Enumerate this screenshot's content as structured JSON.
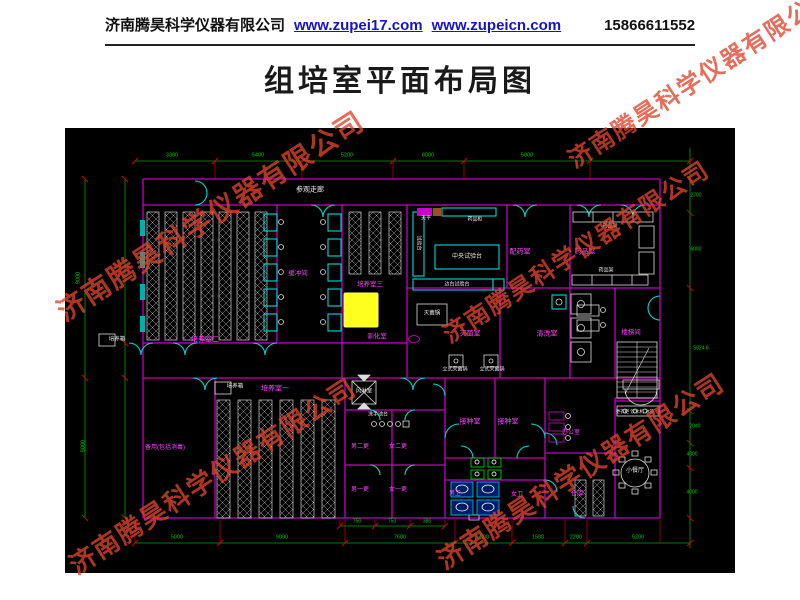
{
  "header": {
    "company": "济南腾昊科学仪器有限公司",
    "url1": "www.zupei17.com",
    "url2": "www.zupeicn.com",
    "phone": "15866611552"
  },
  "title": "组培室平面布局图",
  "watermark": {
    "text": "济南腾昊科学仪器有限公司",
    "color": "#e0452e",
    "positions": [
      {
        "x": 210,
        "y": 215,
        "s": 28
      },
      {
        "x": 700,
        "y": 75,
        "s": 24
      },
      {
        "x": 575,
        "y": 250,
        "s": 24
      },
      {
        "x": 212,
        "y": 475,
        "s": 26
      },
      {
        "x": 580,
        "y": 470,
        "s": 26
      }
    ]
  },
  "plan": {
    "colors": {
      "wall": "#c400c4",
      "door": "#00d8d8",
      "dimension": "#00a000",
      "tick": "#d40000",
      "rack": "#cfcfcf",
      "highlight": "#ffff1e",
      "room_label": "#ff45ff",
      "text": "#e8e8e8"
    },
    "labels": [
      {
        "t": "参观走廊",
        "x": 245,
        "y": 62,
        "cls": "w",
        "s": 7
      },
      {
        "t": "培养箱",
        "x": 52,
        "y": 212,
        "cls": "w",
        "s": 5.5
      },
      {
        "t": "培养室二",
        "x": 140,
        "y": 212,
        "cls": "m",
        "s": 7
      },
      {
        "t": "培养箱",
        "x": 170,
        "y": 259,
        "cls": "w",
        "s": 5.5
      },
      {
        "t": "培养室一",
        "x": 210,
        "y": 261,
        "cls": "m",
        "s": 7
      },
      {
        "t": "缓冲间",
        "x": 233,
        "y": 146,
        "cls": "m",
        "s": 6.5
      },
      {
        "t": "培养室三",
        "x": 305,
        "y": 157,
        "cls": "m",
        "s": 6.5
      },
      {
        "t": "驯化室",
        "x": 312,
        "y": 209,
        "cls": "m",
        "s": 6.5
      },
      {
        "t": "天平",
        "x": 361,
        "y": 91,
        "cls": "w",
        "s": 5
      },
      {
        "t": "药品柜",
        "x": 410,
        "y": 92,
        "cls": "w",
        "s": 5
      },
      {
        "t": "中央试验台",
        "x": 402,
        "y": 129,
        "cls": "w",
        "s": 6
      },
      {
        "t": "边台试验台",
        "x": 392,
        "y": 157,
        "cls": "w",
        "s": 5
      },
      {
        "t": "试验台",
        "x": 353,
        "y": 115,
        "cls": "w",
        "s": 5,
        "r": 90
      },
      {
        "t": "灭菌锅",
        "x": 367,
        "y": 186,
        "cls": "w",
        "s": 5.5
      },
      {
        "t": "灭菌室",
        "x": 405,
        "y": 206,
        "cls": "m",
        "s": 7
      },
      {
        "t": "清洗室",
        "x": 482,
        "y": 206,
        "cls": "m",
        "s": 7
      },
      {
        "t": "立式灭菌锅",
        "x": 390,
        "y": 242,
        "cls": "w",
        "s": 5
      },
      {
        "t": "立式灭菌锅",
        "x": 427,
        "y": 242,
        "cls": "w",
        "s": 5
      },
      {
        "t": "配药室",
        "x": 455,
        "y": 124,
        "cls": "m",
        "s": 7
      },
      {
        "t": "药品室",
        "x": 520,
        "y": 124,
        "cls": "m",
        "s": 7
      },
      {
        "t": "药品架",
        "x": 545,
        "y": 99,
        "cls": "w",
        "s": 5
      },
      {
        "t": "药品架",
        "x": 541,
        "y": 143,
        "cls": "w",
        "s": 5
      },
      {
        "t": "楼梯间",
        "x": 566,
        "y": 205,
        "cls": "m",
        "s": 6.5
      },
      {
        "t": "风淋室",
        "x": 299,
        "y": 264,
        "cls": "w",
        "s": 5.5
      },
      {
        "t": "洗手池台",
        "x": 313,
        "y": 287,
        "cls": "w",
        "s": 5
      },
      {
        "t": "男二更",
        "x": 295,
        "y": 319,
        "cls": "m",
        "s": 6
      },
      {
        "t": "女二更",
        "x": 333,
        "y": 319,
        "cls": "m",
        "s": 6
      },
      {
        "t": "男一更",
        "x": 295,
        "y": 362,
        "cls": "m",
        "s": 6
      },
      {
        "t": "女一更",
        "x": 333,
        "y": 362,
        "cls": "m",
        "s": 6
      },
      {
        "t": "接种室",
        "x": 405,
        "y": 294,
        "cls": "m",
        "s": 7
      },
      {
        "t": "接种室",
        "x": 443,
        "y": 294,
        "cls": "m",
        "s": 7
      },
      {
        "t": "男卫",
        "x": 390,
        "y": 366,
        "cls": "m",
        "s": 6
      },
      {
        "t": "女卫",
        "x": 452,
        "y": 367,
        "cls": "m",
        "s": 6
      },
      {
        "t": "备用(包括消毒)",
        "x": 100,
        "y": 320,
        "cls": "m",
        "s": 6
      },
      {
        "t": "办公室",
        "x": 506,
        "y": 305,
        "cls": "m",
        "s": 6
      },
      {
        "t": "仓库",
        "x": 512,
        "y": 366,
        "cls": "m",
        "s": 6.5
      },
      {
        "t": "小餐厅",
        "x": 570,
        "y": 343,
        "cls": "w",
        "s": 6
      },
      {
        "t": "更衣柜 饮水机 冰箱",
        "x": 570,
        "y": 284,
        "cls": "w",
        "s": 4.5
      },
      {
        "t": "3300",
        "x": 107,
        "y": 28,
        "cls": "d",
        "s": 5.5
      },
      {
        "t": "5400",
        "x": 193,
        "y": 28,
        "cls": "d",
        "s": 5.5
      },
      {
        "t": "5200",
        "x": 282,
        "y": 28,
        "cls": "d",
        "s": 5.5
      },
      {
        "t": "6000",
        "x": 363,
        "y": 28,
        "cls": "d",
        "s": 5.5
      },
      {
        "t": "5000",
        "x": 462,
        "y": 28,
        "cls": "d",
        "s": 5.5
      },
      {
        "t": "750",
        "x": 292,
        "y": 394,
        "cls": "d",
        "s": 5
      },
      {
        "t": "750",
        "x": 327,
        "y": 394,
        "cls": "d",
        "s": 5
      },
      {
        "t": "380",
        "x": 362,
        "y": 394,
        "cls": "d",
        "s": 5
      },
      {
        "t": "5000",
        "x": 112,
        "y": 410,
        "cls": "d",
        "s": 5.5
      },
      {
        "t": "9000",
        "x": 217,
        "y": 410,
        "cls": "d",
        "s": 5.5
      },
      {
        "t": "7600",
        "x": 335,
        "y": 410,
        "cls": "d",
        "s": 5.5
      },
      {
        "t": "6000",
        "x": 418,
        "y": 410,
        "cls": "d",
        "s": 5.5
      },
      {
        "t": "1500",
        "x": 473,
        "y": 410,
        "cls": "d",
        "s": 5.5
      },
      {
        "t": "2200",
        "x": 511,
        "y": 410,
        "cls": "d",
        "s": 5.5
      },
      {
        "t": "5200",
        "x": 573,
        "y": 410,
        "cls": "d",
        "s": 5.5
      },
      {
        "t": "9000",
        "x": 14,
        "y": 150,
        "cls": "d",
        "s": 5.5,
        "r": -90
      },
      {
        "t": "5000",
        "x": 19,
        "y": 318,
        "cls": "d",
        "s": 5.5,
        "r": -90
      },
      {
        "t": "2700",
        "x": 631,
        "y": 68,
        "cls": "d",
        "s": 5
      },
      {
        "t": "6000",
        "x": 631,
        "y": 122,
        "cls": "d",
        "s": 5
      },
      {
        "t": "5024.6",
        "x": 636,
        "y": 221,
        "cls": "d",
        "s": 5
      },
      {
        "t": "2040",
        "x": 630,
        "y": 299,
        "cls": "d",
        "s": 5
      },
      {
        "t": "4000",
        "x": 627,
        "y": 327,
        "cls": "d",
        "s": 5
      },
      {
        "t": "4000",
        "x": 627,
        "y": 365,
        "cls": "d",
        "s": 5
      }
    ]
  }
}
